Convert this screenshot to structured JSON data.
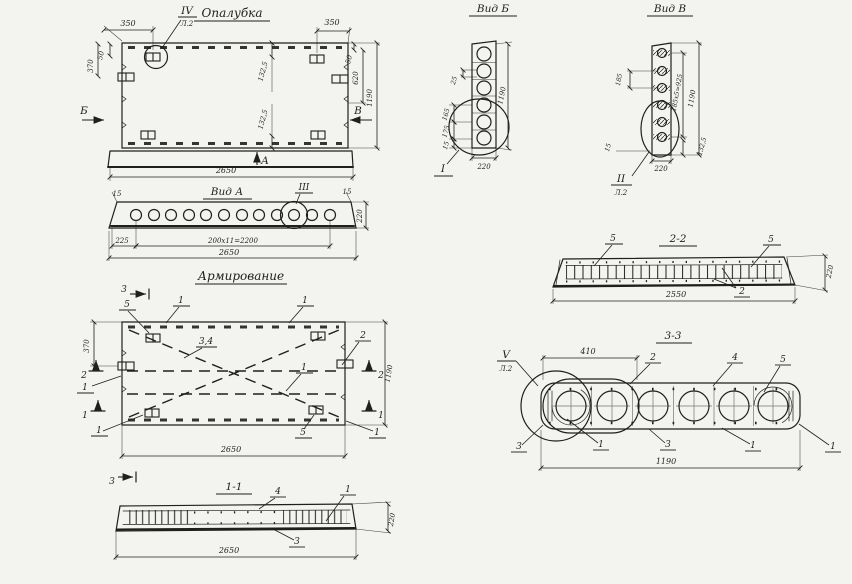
{
  "canvas": {
    "bg": "#f3f3ef",
    "ink": "#1f1f1d"
  },
  "formwork": {
    "title": "Опалубка",
    "detail": {
      "label": "IV",
      "sheet": "Л.2"
    },
    "view_markers": {
      "left": "Б",
      "right": "В",
      "bottom": "А"
    },
    "dims": {
      "top_left": "350",
      "top_right": "350",
      "left_upper": "50",
      "left_lower": "370",
      "inner_upper": "132,5",
      "inner_lower": "132,5",
      "right_small": "50",
      "right_mid": "620",
      "right_total": "1190",
      "bottom_total": "2650"
    }
  },
  "view_a": {
    "title": "Вид А",
    "detail": "III",
    "dims": {
      "edge_left": "15",
      "edge_right": "15",
      "height": "220",
      "first": "225",
      "pitch": "200х11=2200",
      "total": "2650"
    }
  },
  "view_b": {
    "title": "Вид Б",
    "detail": "I",
    "dims": {
      "pitch_small": "25",
      "d165": "165",
      "d175": "175",
      "d15": "15",
      "height_total": "1190",
      "width": "220"
    }
  },
  "view_v": {
    "title": "Вид В",
    "detail": {
      "label": "II",
      "sheet": "Л.2"
    },
    "dims": {
      "pitch": "185",
      "pitch_total": "185х5=925",
      "height_total": "1190",
      "bottom_offset": "132,5",
      "edge": "15",
      "width": "220"
    }
  },
  "section_2_2": {
    "title": "2-2",
    "labels": {
      "left": "5",
      "right": "5",
      "bottom": "2"
    },
    "dims": {
      "length": "2550",
      "height": "220"
    }
  },
  "reinforcement": {
    "title": "Армирование",
    "cut_markers": {
      "top": "3",
      "bottom": "3",
      "left_mid": "2",
      "right_mid": "2",
      "left_low": "1",
      "right_low": "1"
    },
    "labels": {
      "loop_top": "5",
      "bar_top": "1",
      "bar_top_right": "1",
      "diag": "3,4",
      "bar_mid": "2",
      "bar_mid_right": "1",
      "bar_left": "1",
      "loop_bottom_left": "1",
      "loop_bottom": "5",
      "bar_bottom_right": "1"
    },
    "dims": {
      "left": "370",
      "right_total": "1190",
      "bottom_total": "2650"
    }
  },
  "section_3_3": {
    "title": "3-3",
    "detail": {
      "label": "V",
      "sheet": "Л.2"
    },
    "labels": {
      "top_a": "2",
      "top_b": "4",
      "top_c": "5",
      "bottom_a": "3",
      "bottom_b": "1",
      "bottom_c": "3",
      "bottom_d": "1",
      "bottom_e": "1"
    },
    "dims": {
      "detail_width": "410",
      "width_total": "1190"
    }
  },
  "section_1_1": {
    "title": "1-1",
    "labels": {
      "top_a": "4",
      "top_b": "1",
      "bottom": "3"
    },
    "dims": {
      "length": "2650",
      "height": "220"
    }
  }
}
